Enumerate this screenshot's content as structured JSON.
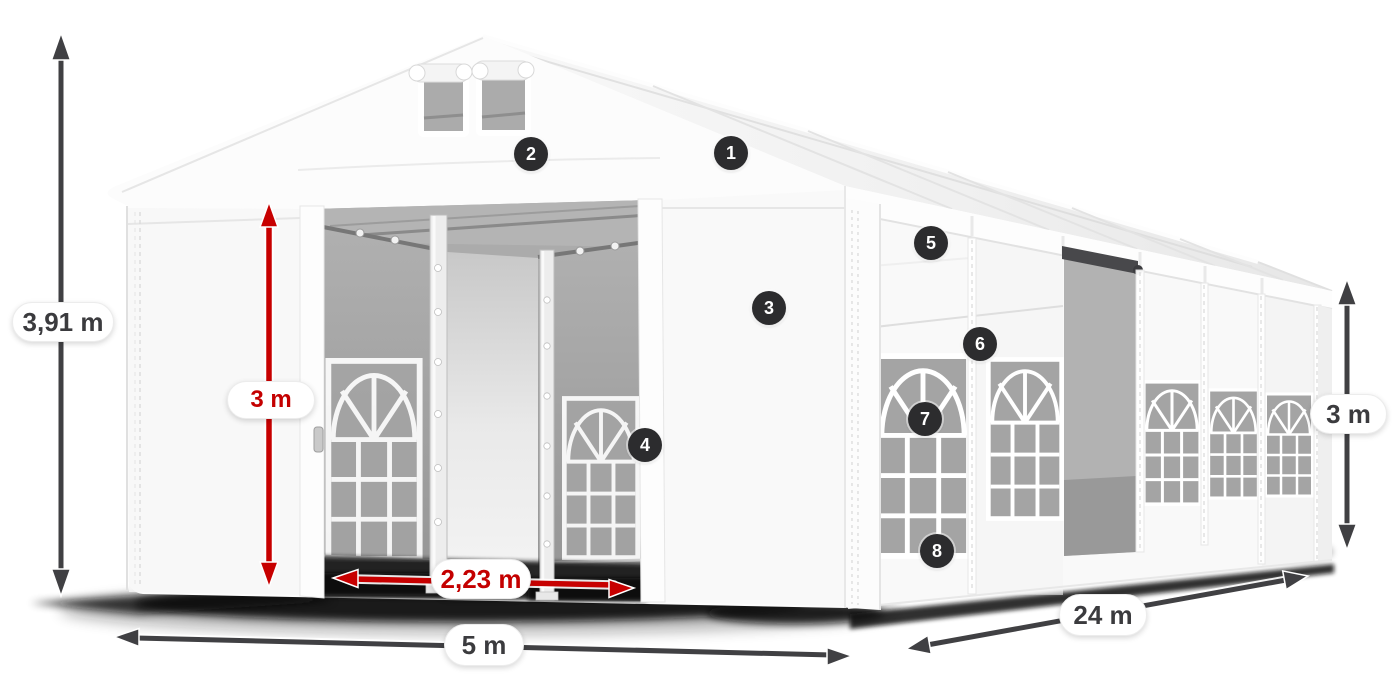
{
  "diagram": {
    "subject": "party tent with open front entrance, gable windows and arched side windows",
    "labels": {
      "total_height": "3,91 m",
      "door_height": "3 m",
      "door_width": "2,23 m",
      "tent_width": "5 m",
      "tent_length": "24 m",
      "side_height": "3 m"
    },
    "callouts": {
      "c1": "1",
      "c2": "2",
      "c3": "3",
      "c4": "4",
      "c5": "5",
      "c6": "6",
      "c7": "7",
      "c8": "8"
    },
    "colors": {
      "accent_red": "#c40000",
      "arrow_dark": "#404043",
      "badge_bg": "#2c2c2e",
      "label_text": "#3b3b3e",
      "background": "#ffffff"
    }
  }
}
